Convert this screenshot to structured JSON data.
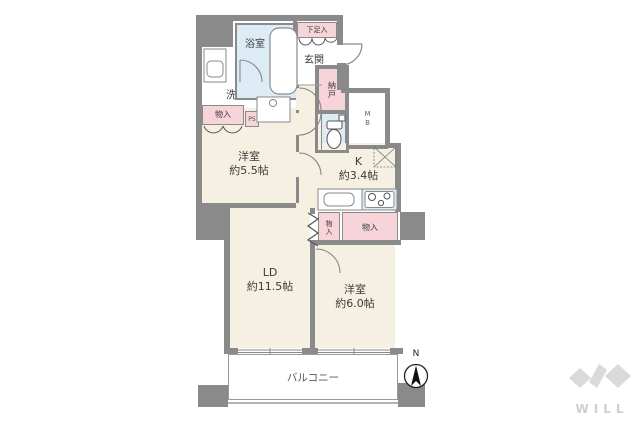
{
  "floorplan": {
    "rooms": {
      "bath": {
        "label": "浴室"
      },
      "shoe_cabinet": {
        "label": "下足入"
      },
      "entrance": {
        "label": "玄関"
      },
      "washroom": {
        "label": "洗面室"
      },
      "storage_nando": {
        "label": "納戸"
      },
      "meter_box": {
        "label": "MB"
      },
      "pipe_space_left": {
        "label": "PS"
      },
      "pipe_space_right": {
        "label": "PS"
      },
      "closet_bedroom1": {
        "label": "物入"
      },
      "bedroom1": {
        "name": "洋室",
        "size": "約5.5帖"
      },
      "kitchen": {
        "name": "K",
        "size": "約3.4帖"
      },
      "closet_narrow": {
        "label": "物入"
      },
      "closet_wide": {
        "label": "物入"
      },
      "living_dining": {
        "name": "LD",
        "size": "約11.5帖"
      },
      "bedroom2": {
        "name": "洋室",
        "size": "約6.0帖"
      },
      "balcony": {
        "label": "バルコニー"
      }
    },
    "compass": {
      "north_label": "N"
    },
    "logo": {
      "text": "WILL"
    },
    "colors": {
      "wall": "#8a8a8a",
      "floor_cream": "#f6f0e2",
      "floor_blue": "#dcebf4",
      "closet_pink": "#f6d4da",
      "logo_gray": "#d9d9d9"
    }
  }
}
